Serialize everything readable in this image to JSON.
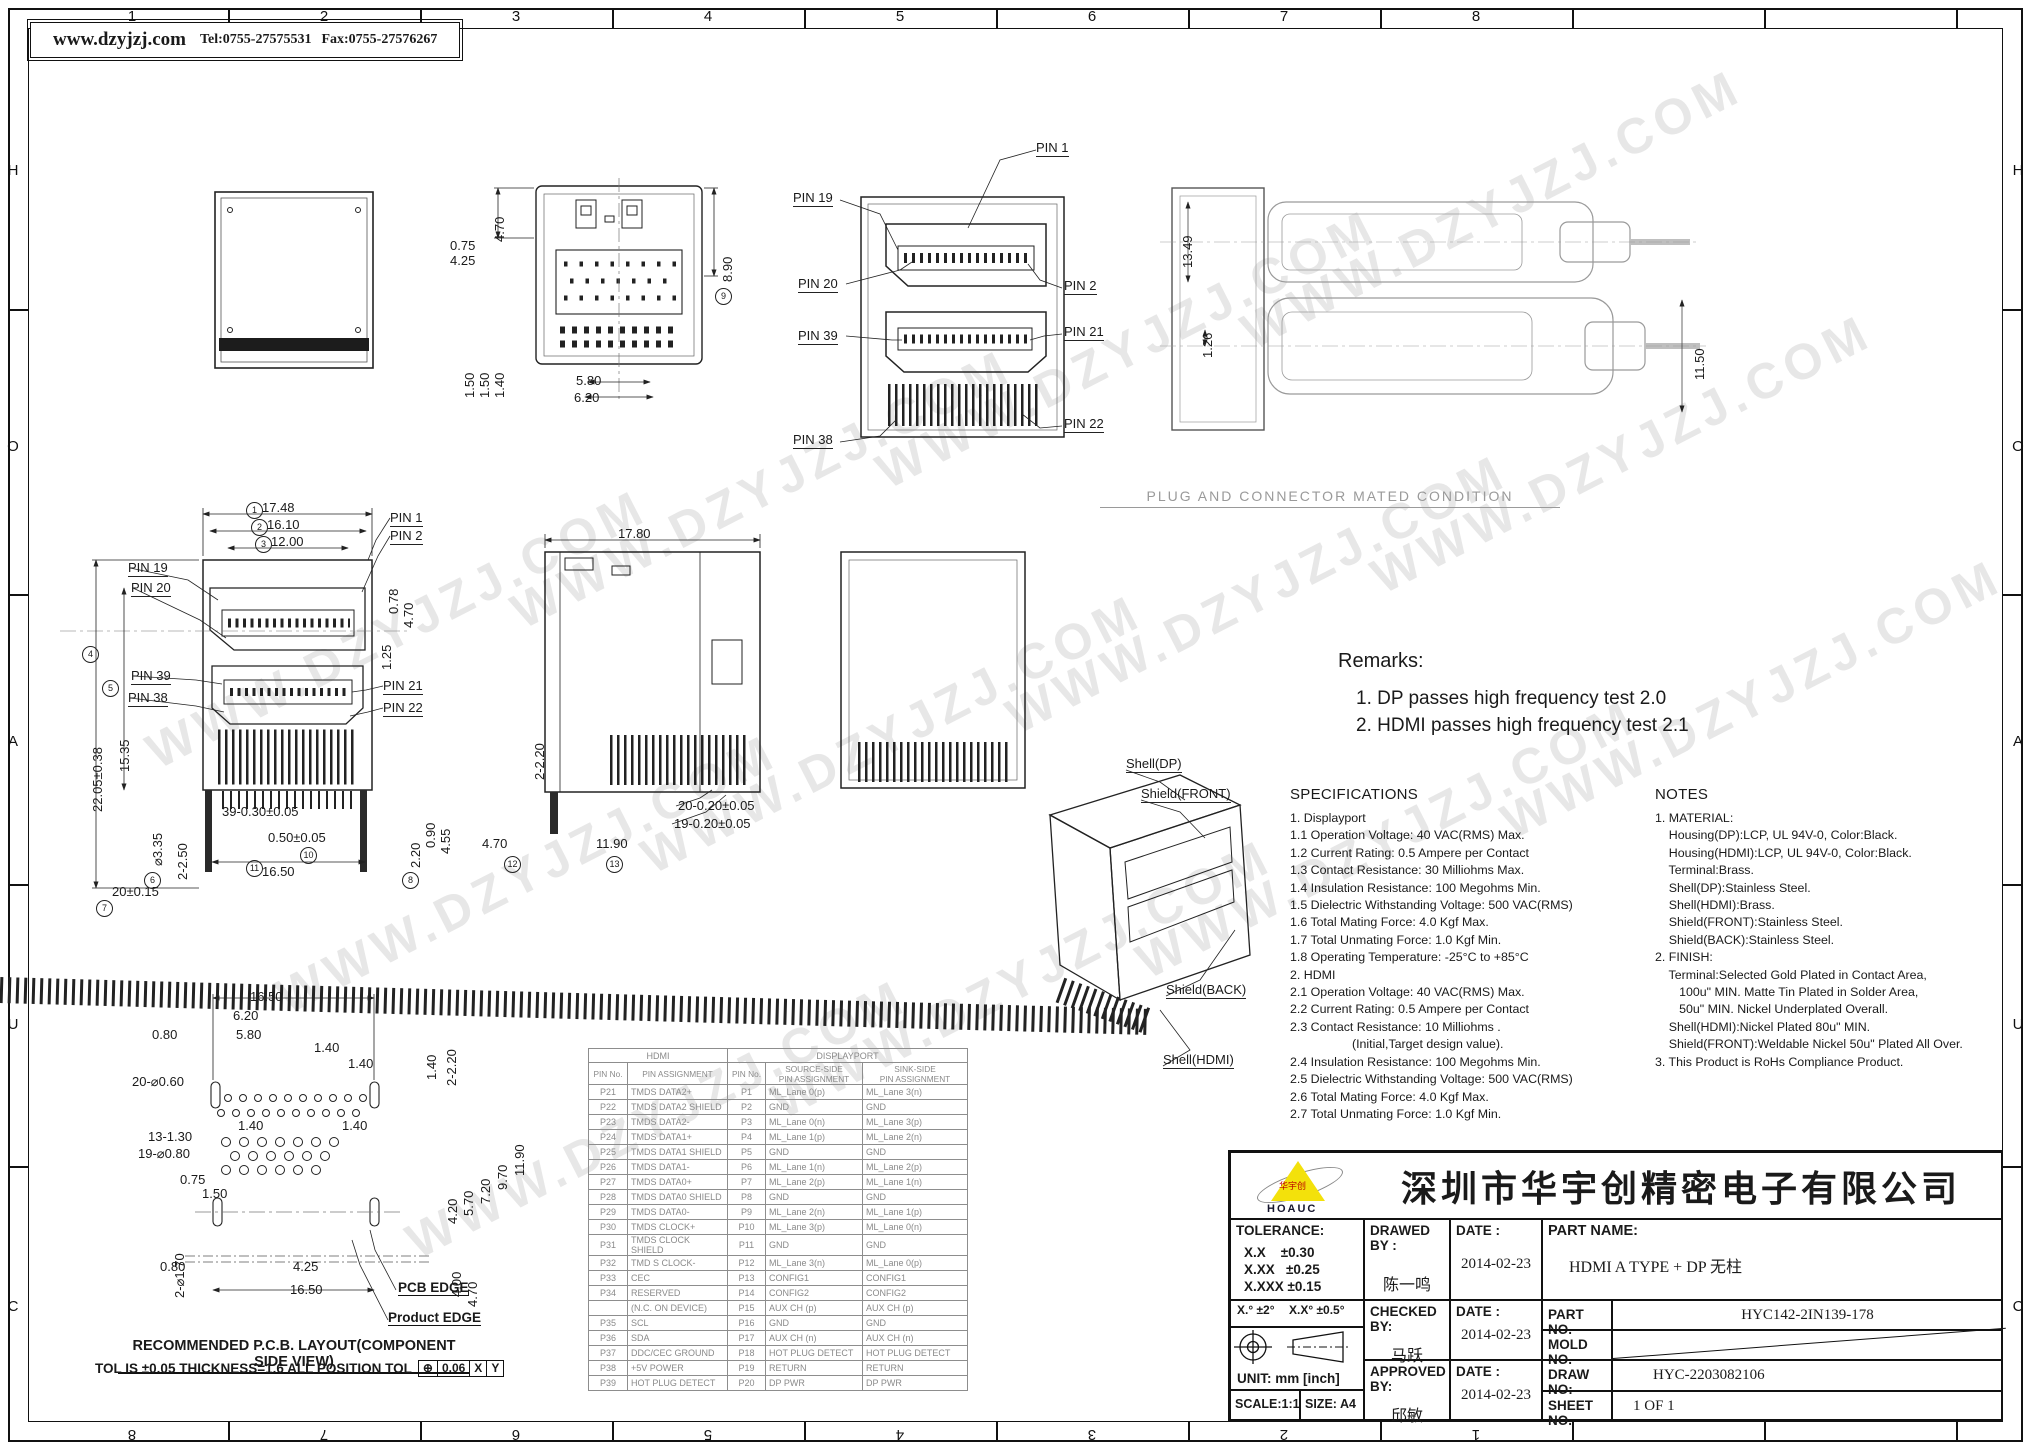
{
  "page": {
    "watermark": "WWW.DZYJZJ.COM"
  },
  "header": {
    "website": "www.dzyjzj.com",
    "tel": "Tel:0755-27575531",
    "fax": "Fax:0755-27576267"
  },
  "border": {
    "columns": [
      "1",
      "2",
      "3",
      "4",
      "5",
      "6",
      "7",
      "8"
    ],
    "rows": [
      "H",
      "O",
      "A",
      "U",
      "C"
    ]
  },
  "captions": {
    "mated": "PLUG AND CONNECTOR MATED CONDITION",
    "pcb_layout": "RECOMMENDED P.C.B. LAYOUT(COMPONENT SIDE VIEW)",
    "pcb_tol": "TOL IS ±0.05 THICKNESS=1.6 ALL POSITION TOL",
    "pcb_tol_frame": [
      "⊕",
      "0.06",
      "X",
      "Y"
    ],
    "pcb_edge": "PCB EDGE",
    "product_edge": "Product EDGE"
  },
  "remarks": {
    "title": "Remarks:",
    "items": [
      "1. DP passes high frequency test 2.0",
      "2. HDMI passes high frequency test 2.1"
    ]
  },
  "specifications": {
    "title": "SPECIFICATIONS",
    "lines": [
      "1. Displayport",
      "1.1 Operation Voltage: 40 VAC(RMS) Max.",
      "1.2 Current Rating: 0.5 Ampere per Contact",
      "1.3 Contact Resistance: 30 Milliohms Max.",
      "1.4 Insulation Resistance: 100 Megohms Min.",
      "1.5 Dielectric Withstanding Voltage: 500 VAC(RMS)",
      "1.6 Total Mating Force: 4.0 Kgf Max.",
      "1.7 Total Unmating Force: 1.0 Kgf Min.",
      "1.8 Operating Temperature: -25°C to +85°C",
      "2. HDMI",
      "2.1 Operation Voltage: 40 VAC(RMS) Max.",
      "2.2 Current Rating: 0.5 Ampere per Contact",
      "2.3 Contact Resistance: 10 Milliohms .",
      "                  (Initial,Target design value).",
      "2.4 Insulation Resistance: 100 Megohms Min.",
      "2.5 Dielectric Withstanding Voltage: 500 VAC(RMS)",
      "2.6 Total Mating Force: 4.0 Kgf Max.",
      "2.7 Total Unmating Force: 1.0 Kgf Min."
    ]
  },
  "notes": {
    "title": "NOTES",
    "lines": [
      "1. MATERIAL:",
      "    Housing(DP):LCP, UL 94V-0, Color:Black.",
      "    Housing(HDMI):LCP, UL 94V-0, Color:Black.",
      "    Terminal:Brass.",
      "    Shell(DP):Stainless Steel.",
      "    Shell(HDMI):Brass.",
      "    Shield(FRONT):Stainless Steel.",
      "    Shield(BACK):Stainless Steel.",
      "2. FINISH:",
      "    Terminal:Selected Gold Plated in Contact Area,",
      "       100u\" MIN. Matte Tin Plated in Solder Area,",
      "       50u\" MIN. Nickel Underplated Overall.",
      "    Shell(HDMI):Nickel Plated 80u\" MIN.",
      "    Shield(FRONT):Weldable Nickel 50u\" Plated All Over.",
      "3. This Product is RoHs Compliance Product."
    ]
  },
  "dims": {
    "top_view": [
      "4.70",
      "0.75",
      "4.25",
      "8.90",
      "1.50",
      "1.50",
      "1.40",
      "5.80",
      "6.20"
    ],
    "plug_front": [
      "PIN 1",
      "PIN 19",
      "PIN 20",
      "PIN 2",
      "PIN 39",
      "PIN 21",
      "PIN 38",
      "PIN 22"
    ],
    "mated_view": [
      "13.49",
      "1.26",
      "11.50"
    ],
    "front_view": [
      "17.48",
      "16.10",
      "12.00",
      "PIN 1",
      "PIN 2",
      "PIN 19",
      "PIN 20",
      "PIN 39",
      "PIN 38",
      "PIN 21",
      "PIN 22",
      "22.05±0.38",
      "15.35",
      "0.78",
      "4.70",
      "1.25",
      "2-2.50",
      "⌀3.35",
      "39-0.30±0.05",
      "0.50±0.05",
      "16.50",
      "20±0.15",
      "2.20",
      "0.90",
      "4.55"
    ],
    "side_view": [
      "17.80",
      "2-2.20",
      "4.70",
      "11.90",
      "20-0.20±0.05",
      "19-0.20±0.05"
    ],
    "iso_view": [
      "Shell(DP)",
      "Shield(FRONT)",
      "Shield(BACK)",
      "Shell(HDMI)"
    ],
    "pcb": [
      "16.50",
      "6.20",
      "5.80",
      "0.80",
      "1.40",
      "1.40",
      "1.40",
      "1.40",
      "1.40",
      "2-2.20",
      "20-⌀0.60",
      "13-1.30",
      "19-⌀0.80",
      "0.75",
      "1.50",
      "2-⌀1.70",
      "0.80",
      "4.25",
      "16.50",
      "4.20",
      "5.70",
      "7.20",
      "9.70",
      "11.90",
      "4.00",
      "4.70"
    ],
    "balloons": [
      "1",
      "2",
      "3",
      "4",
      "5",
      "6",
      "7",
      "8",
      "9",
      "10",
      "11",
      "12",
      "13"
    ]
  },
  "pin_table": {
    "group_headers": [
      "HDMI",
      "DISPLAYPORT"
    ],
    "col_headers": [
      "PIN No.",
      "PIN ASSIGNMENT",
      "PIN No.",
      "SOURCE-SIDE\nPIN ASSIGNMENT",
      "SINK-SIDE\nPIN ASSIGNMENT"
    ],
    "rows": [
      [
        "P21",
        "TMDS DATA2+",
        "P1",
        "ML_Lane 0(p)",
        "ML_Lane 3(n)"
      ],
      [
        "P22",
        "TMDS DATA2 SHIELD",
        "P2",
        "GND",
        "GND"
      ],
      [
        "P23",
        "TMDS DATA2-",
        "P3",
        "ML_Lane 0(n)",
        "ML_Lane 3(p)"
      ],
      [
        "P24",
        "TMDS DATA1+",
        "P4",
        "ML_Lane 1(p)",
        "ML_Lane 2(n)"
      ],
      [
        "P25",
        "TMDS DATA1 SHIELD",
        "P5",
        "GND",
        "GND"
      ],
      [
        "P26",
        "TMDS DATA1-",
        "P6",
        "ML_Lane 1(n)",
        "ML_Lane 2(p)"
      ],
      [
        "P27",
        "TMDS DATA0+",
        "P7",
        "ML_Lane 2(p)",
        "ML_Lane 1(n)"
      ],
      [
        "P28",
        "TMDS DATA0 SHIELD",
        "P8",
        "GND",
        "GND"
      ],
      [
        "P29",
        "TMDS DATA0-",
        "P9",
        "ML_Lane 2(n)",
        "ML_Lane 1(p)"
      ],
      [
        "P30",
        "TMDS CLOCK+",
        "P10",
        "ML_Lane 3(p)",
        "ML_Lane 0(n)"
      ],
      [
        "P31",
        "TMDS CLOCK SHIELD",
        "P11",
        "GND",
        "GND"
      ],
      [
        "P32",
        "TMD S CLOCK-",
        "P12",
        "ML_Lane 3(n)",
        "ML_Lane 0(p)"
      ],
      [
        "P33",
        "CEC",
        "P13",
        "CONFIG1",
        "CONFIG1"
      ],
      [
        "P34",
        "RESERVED",
        "P14",
        "CONFIG2",
        "CONFIG2"
      ],
      [
        "",
        "(N.C. ON DEVICE)",
        "P15",
        "AUX CH (p)",
        "AUX CH (p)"
      ],
      [
        "P35",
        "SCL",
        "P16",
        "GND",
        "GND"
      ],
      [
        "P36",
        "SDA",
        "P17",
        "AUX CH (n)",
        "AUX CH (n)"
      ],
      [
        "P37",
        "DDC/CEC GROUND",
        "P18",
        "HOT PLUG DETECT",
        "HOT PLUG DETECT"
      ],
      [
        "P38",
        "+5V POWER",
        "P19",
        "RETURN",
        "RETURN"
      ],
      [
        "P39",
        "HOT PLUG DETECT",
        "P20",
        "DP PWR",
        "DP PWR"
      ]
    ]
  },
  "title_block": {
    "logo_text": "HOAUC",
    "logo_mark": "华宇创",
    "company": "深圳市华宇创精密电子有限公司",
    "tolerance_title": "TOLERANCE:",
    "tolerances": [
      "X.X    ±0.30",
      "X.XX   ±0.25",
      "X.XXX ±0.15"
    ],
    "angle_tol_1": "X.°  ±2°",
    "angle_tol_2": "X.X°  ±0.5°",
    "unit": "UNIT:  mm  [inch]",
    "scale": "SCALE:1:1",
    "size": "SIZE:  A4",
    "fields": {
      "drawed_label": "DRAWED BY :",
      "drawed_value": "陈一鸣",
      "date_label": "DATE :",
      "date1": "2014-02-23",
      "part_name_label": "PART NAME:",
      "part_name_value": "HDMI A TYPE + DP 无柱",
      "checked_label": "CHECKED BY:",
      "checked_value": "马跃",
      "date2": "2014-02-23",
      "part_no_label": "PART NO.",
      "part_no_value": "HYC142-2IN139-178",
      "mold_no_label": "MOLD NO.",
      "approved_label": "APPROVED BY:",
      "approved_value": "邱敏",
      "date3": "2014-02-23",
      "draw_no_label": "DRAW NO:",
      "draw_no_value": "HYC-2203082106",
      "sheet_no_label": "SHEET NO.",
      "sheet_no_value": "1 OF 1"
    }
  },
  "colors": {
    "accent_yellow": "#f3e10b",
    "line": "#1a1a1a",
    "table_gray": "#8a8a8a",
    "watermark_gray": "#878787"
  }
}
